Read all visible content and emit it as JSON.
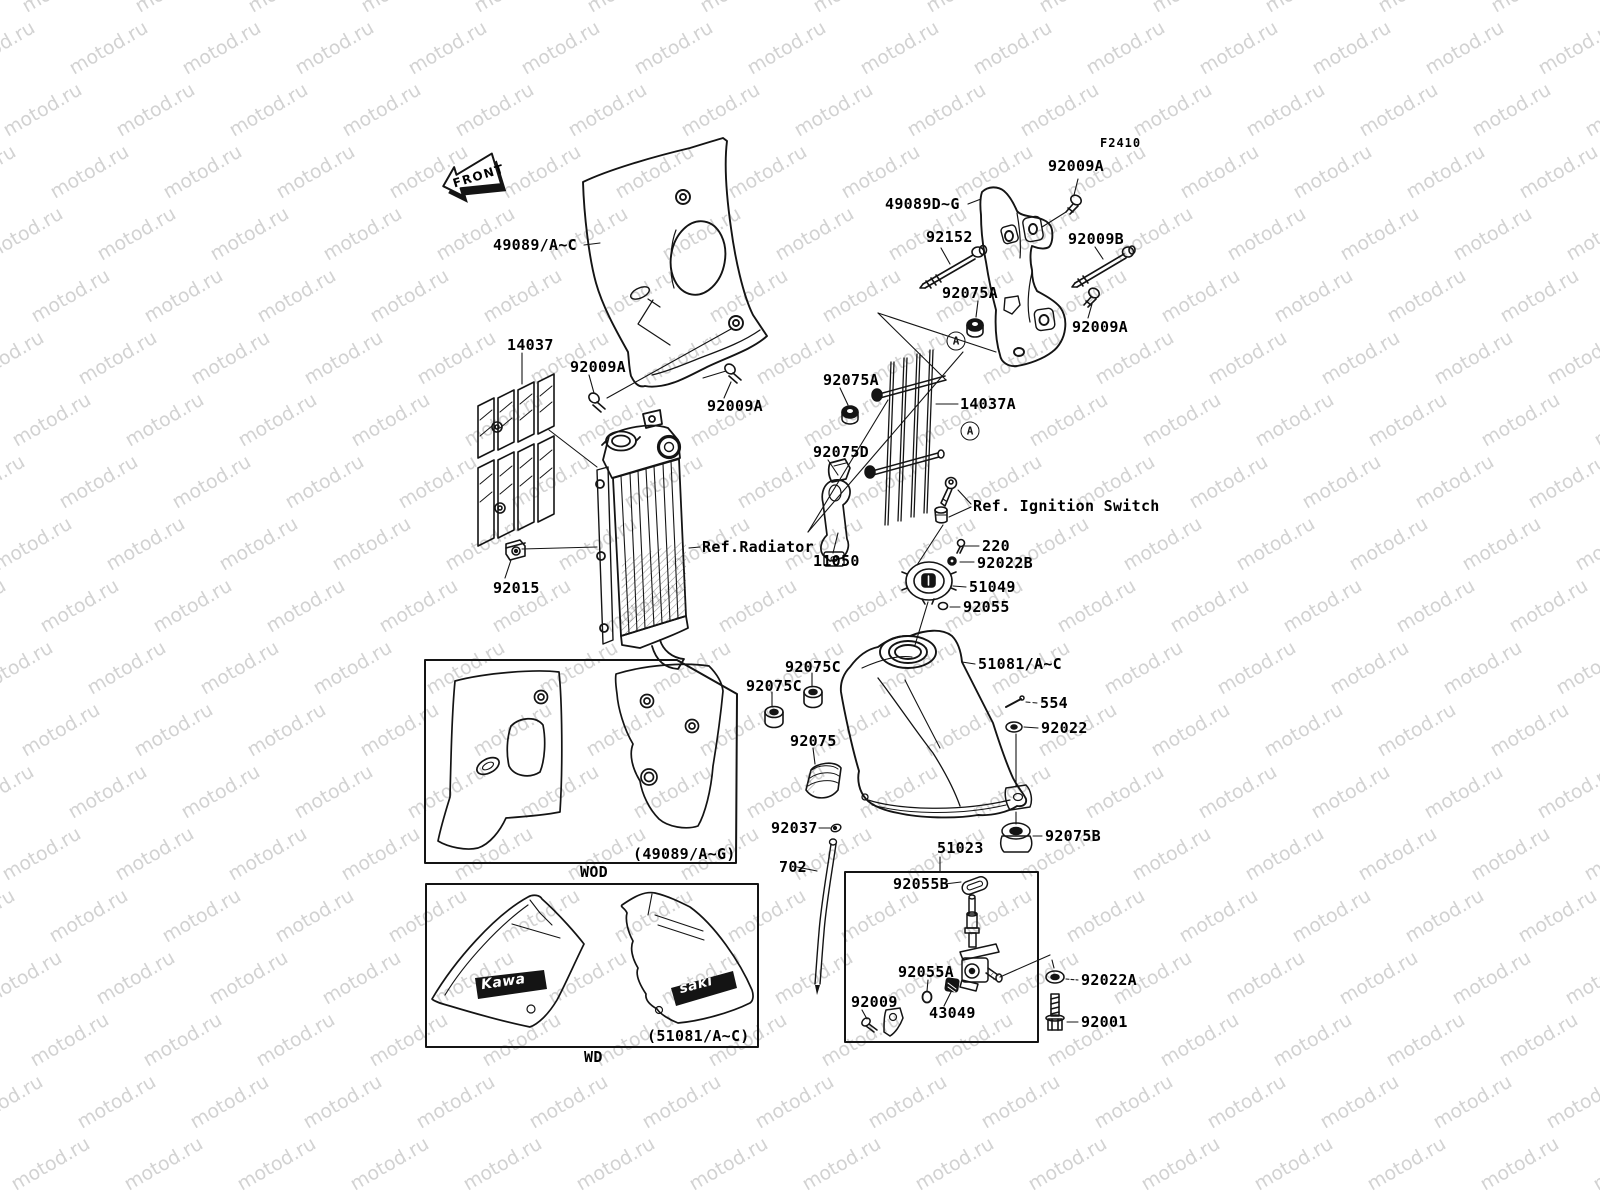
{
  "watermark": {
    "text": "motod.ru",
    "color": "#d2d2d2"
  },
  "front_marker": {
    "text": "FRONT"
  },
  "logo": {
    "left": "Kawa",
    "right": "saki"
  },
  "markers": [
    {
      "text": "A",
      "x": 956,
      "y": 341
    },
    {
      "text": "A",
      "x": 970,
      "y": 431
    }
  ],
  "labels": [
    {
      "text": "F2410",
      "x": 1100,
      "y": 143,
      "cls": "small"
    },
    {
      "text": "92009A",
      "x": 1048,
      "y": 166
    },
    {
      "text": "49089D~G",
      "x": 885,
      "y": 204
    },
    {
      "text": "92152",
      "x": 926,
      "y": 237
    },
    {
      "text": "92009B",
      "x": 1068,
      "y": 239
    },
    {
      "text": "49089/A~C",
      "x": 493,
      "y": 245
    },
    {
      "text": "92075A",
      "x": 942,
      "y": 293
    },
    {
      "text": "92009A",
      "x": 1072,
      "y": 327
    },
    {
      "text": "14037",
      "x": 507,
      "y": 345
    },
    {
      "text": "92009A",
      "x": 570,
      "y": 367
    },
    {
      "text": "92075A",
      "x": 823,
      "y": 380
    },
    {
      "text": "14037A",
      "x": 960,
      "y": 404
    },
    {
      "text": "92009A",
      "x": 707,
      "y": 406
    },
    {
      "text": "92075D",
      "x": 813,
      "y": 452
    },
    {
      "text": "Ref. Ignition Switch",
      "x": 973,
      "y": 506
    },
    {
      "text": "220",
      "x": 982,
      "y": 546
    },
    {
      "text": "Ref.Radiator",
      "x": 702,
      "y": 547
    },
    {
      "text": "11050",
      "x": 813,
      "y": 561
    },
    {
      "text": "92022B",
      "x": 977,
      "y": 563
    },
    {
      "text": "51049",
      "x": 969,
      "y": 587
    },
    {
      "text": "92015",
      "x": 493,
      "y": 588
    },
    {
      "text": "92055",
      "x": 963,
      "y": 607
    },
    {
      "text": "51081/A~C",
      "x": 978,
      "y": 664
    },
    {
      "text": "92075C",
      "x": 785,
      "y": 667
    },
    {
      "text": "92075C",
      "x": 746,
      "y": 686
    },
    {
      "text": "554",
      "x": 1040,
      "y": 703
    },
    {
      "text": "92022",
      "x": 1041,
      "y": 728
    },
    {
      "text": "92075",
      "x": 790,
      "y": 741
    },
    {
      "text": "92037",
      "x": 771,
      "y": 828
    },
    {
      "text": "92075B",
      "x": 1045,
      "y": 836
    },
    {
      "text": "51023",
      "x": 937,
      "y": 848
    },
    {
      "text": "(49089/A~G)",
      "x": 633,
      "y": 854
    },
    {
      "text": "702",
      "x": 779,
      "y": 867
    },
    {
      "text": "WOD",
      "x": 580,
      "y": 872
    },
    {
      "text": "92055B",
      "x": 893,
      "y": 884
    },
    {
      "text": "92055A",
      "x": 898,
      "y": 972
    },
    {
      "text": "92022A",
      "x": 1081,
      "y": 980
    },
    {
      "text": "92009",
      "x": 851,
      "y": 1002
    },
    {
      "text": "43049",
      "x": 929,
      "y": 1013
    },
    {
      "text": "92001",
      "x": 1081,
      "y": 1022
    },
    {
      "text": "(51081/A~C)",
      "x": 647,
      "y": 1036
    },
    {
      "text": "WD",
      "x": 584,
      "y": 1057
    }
  ]
}
